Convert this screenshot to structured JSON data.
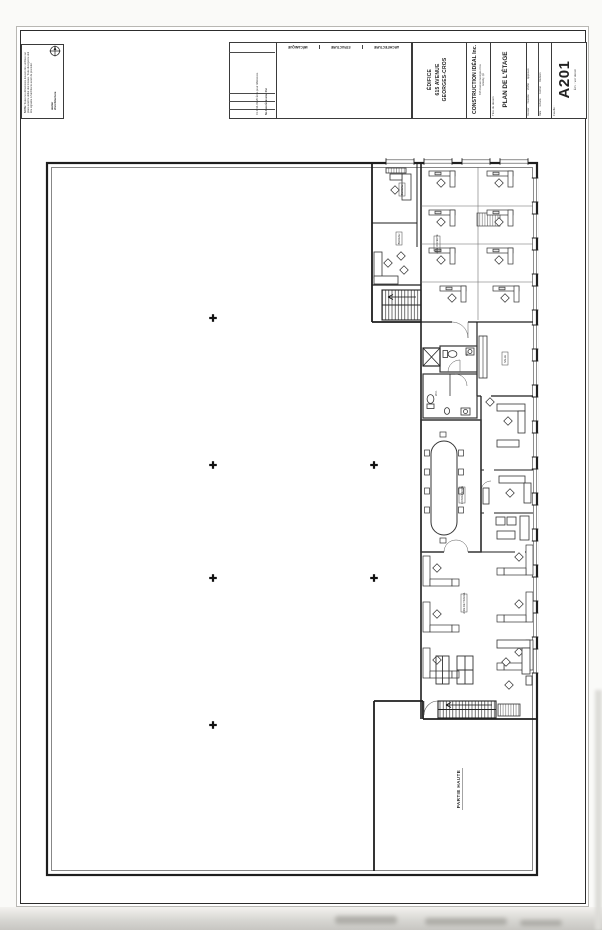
{
  "title_block": {
    "note": {
      "heading": "NOTE:",
      "body": "Toutes les dimensions doivent être vérifiées sur place avant le début des travaux. Toute divergence doit être signalée à l'architecte avant de procéder.",
      "firm": "atelier\nd'architecture"
    },
    "consultants": [
      "MÉCANIQUE",
      "STRUCTURE",
      "ARCHITECTURE"
    ],
    "revisions": {
      "values": "01   2014-03-26   Émis pour références",
      "headers": "No    Date    Émission    Par"
    },
    "project": {
      "line1": "ÉDIFICE",
      "line2": "615 AVENUE",
      "line3": "GEORGES-CROS"
    },
    "client": {
      "name": "CONSTRUCTION IDÉAL Inc.",
      "address1": "615 Avenue Georges-Cros",
      "address2": "Granby, Qc"
    },
    "drawing": {
      "label": "Titre du dessin",
      "title": "PLAN DE L'ÉTAGE"
    },
    "fields": {
      "col1": "Dossier      Dessiné      Vérifié      Approuvé",
      "col2": "Date      Échelle      Format      Révision"
    },
    "sheet": {
      "label": "Feuille :",
      "number": "A201",
      "scale": "Éch. : voir dessin"
    }
  },
  "plan": {
    "rooms": {
      "bureau1": "BUREAU",
      "bureau2": "BUREAU",
      "aire_ouverte": "AIRE OUVERTE",
      "wc1": "W.C.",
      "salle": "SALLE",
      "wc2": "W.C.",
      "conference": "CONFÉRENCE",
      "aire_travail": "AIRE DE TRAVAIL",
      "partie_haute": "PARTIE HAUTE"
    }
  }
}
